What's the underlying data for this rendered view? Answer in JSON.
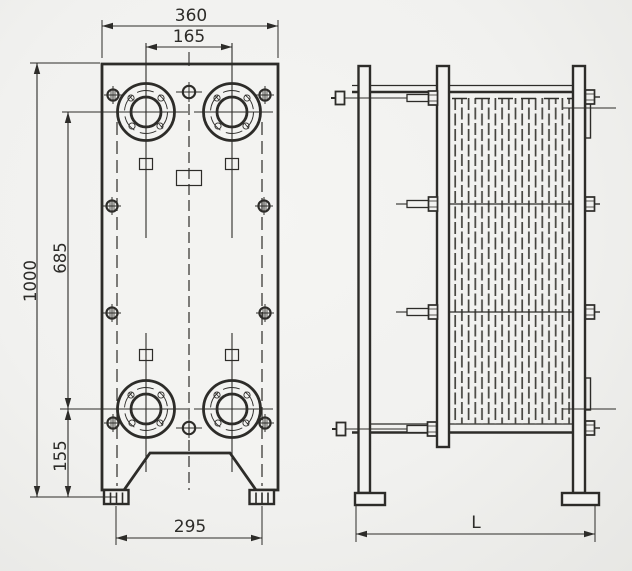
{
  "drawing": {
    "type": "technical-drawing",
    "subject": "plate-heat-exchanger-two-view-drawing",
    "colors": {
      "background": "#f1f1ef",
      "background_edge": "#e7e7e4",
      "line": "#2d2c29",
      "plate_pack_line": "#45443f"
    },
    "front_view": {
      "ports": 4,
      "corner_bolts": 8,
      "dims": {
        "width": "360",
        "port_spacing_h": "165",
        "overall_height": "1000",
        "port_spacing_v": "685",
        "bottom_port_offset": "155",
        "foot_spacing": "295"
      }
    },
    "side_view": {
      "tie_bolt_rows": 4,
      "dims": {
        "overall_length": "L"
      }
    }
  }
}
